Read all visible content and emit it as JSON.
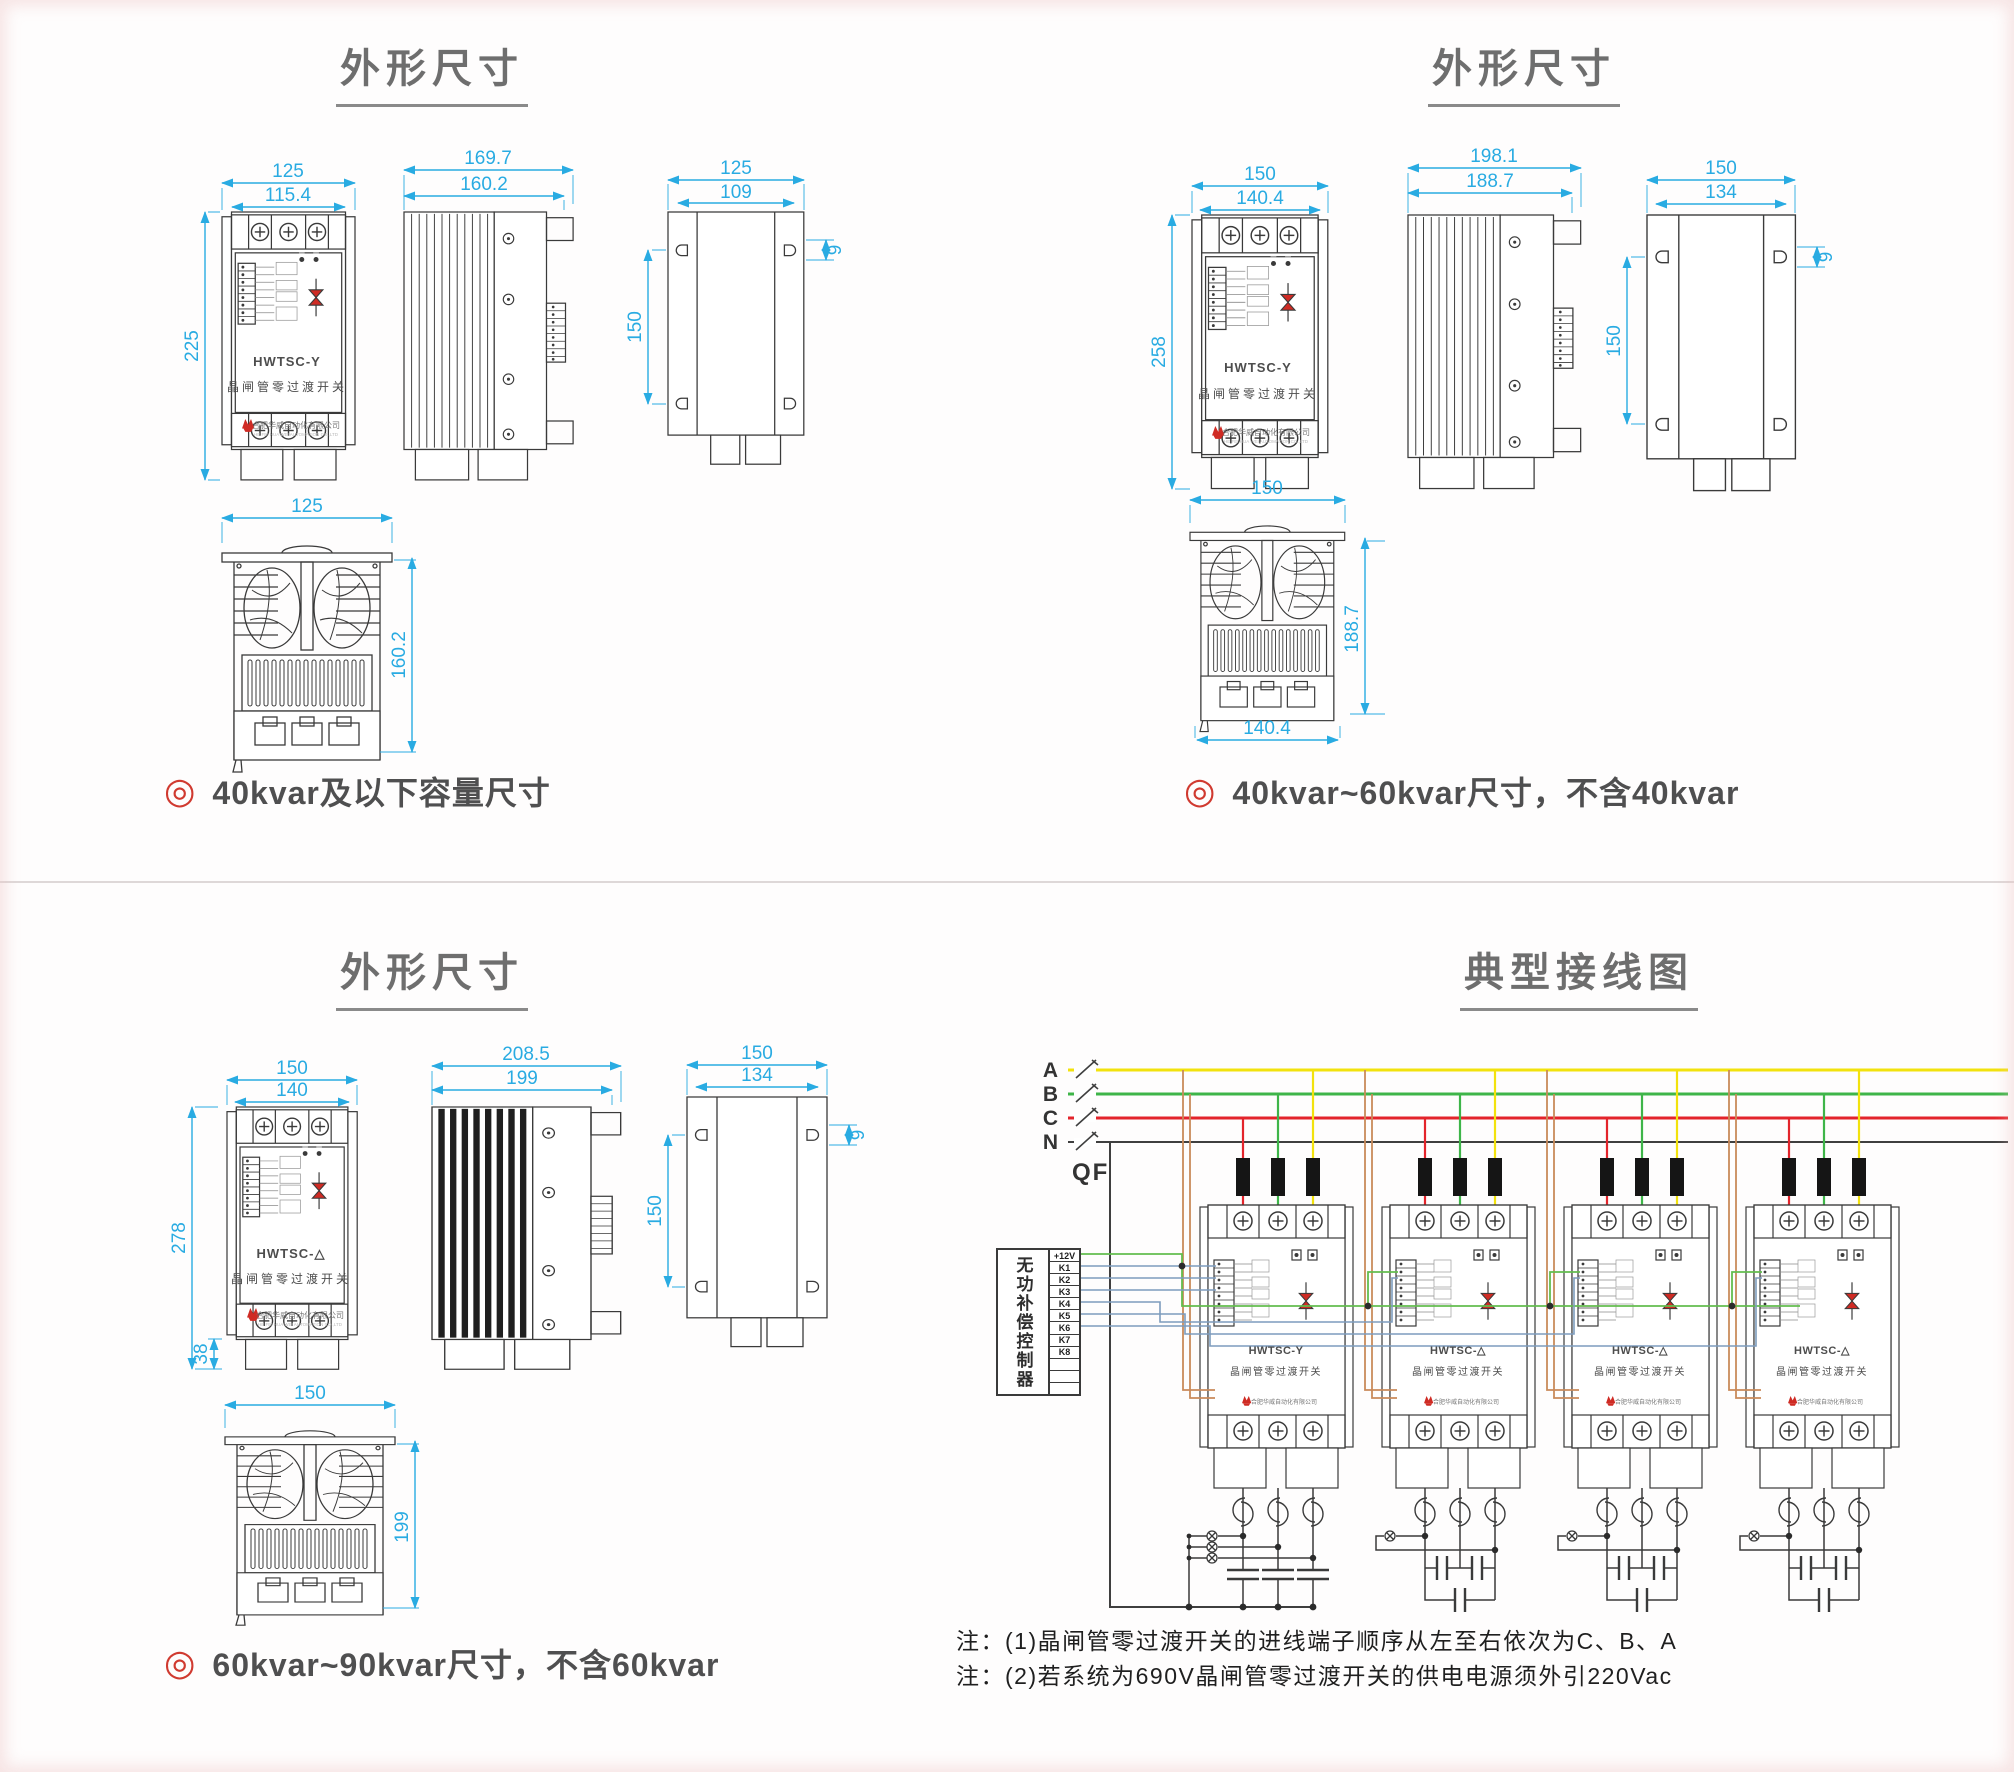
{
  "colors": {
    "dimension": "#29abe2",
    "line_art": "#3a3a3a",
    "accent_red": "#cf2b24",
    "caption_text": "#4f4f50",
    "phase_a_yellow": "#f2e20d",
    "phase_b_green": "#3eb549",
    "phase_c_red": "#e3242b",
    "neutral_black": "#3f3f3f",
    "control_wire_blue": "#7d9cbd",
    "power_wire_green": "#63bd4e",
    "sample_wire_tan": "#c98a5a"
  },
  "quadrants": {
    "tl": {
      "title": "外形尺寸",
      "caption_bullet": "◎",
      "caption": "40kvar及以下容量尺寸",
      "front": {
        "model": "HWTSC-Y",
        "subtitle": "晶闸管零过渡开关",
        "company": "合肥华威自动化有限公司",
        "company_en": "HE FEI HUA WEI AUTOMATION CO.,LTD",
        "dim_outer_width": "125",
        "dim_inner_width": "115.4",
        "dim_height": "225"
      },
      "side": {
        "dim_outer_depth": "169.7",
        "dim_inner_depth": "160.2"
      },
      "back": {
        "dim_outer_width": "125",
        "dim_inner_width": "109",
        "dim_hole_span": "150",
        "dim_hole_offset": "9"
      },
      "top": {
        "dim_width": "125",
        "dim_depth": "160.2"
      }
    },
    "tr": {
      "title": "外形尺寸",
      "caption_bullet": "◎",
      "caption": "40kvar~60kvar尺寸，不含40kvar",
      "front": {
        "model": "HWTSC-Y",
        "subtitle": "晶闸管零过渡开关",
        "company": "合肥华威自动化有限公司",
        "company_en": "HE FEI HUA WEI AUTOMATION CO.,LTD",
        "dim_outer_width": "150",
        "dim_inner_width": "140.4",
        "dim_height": "258"
      },
      "side": {
        "dim_outer_depth": "198.1",
        "dim_inner_depth": "188.7"
      },
      "back": {
        "dim_outer_width": "150",
        "dim_inner_width": "134",
        "dim_hole_span": "150",
        "dim_hole_offset": "9"
      },
      "top": {
        "dim_width": "150",
        "dim_height": "188.7",
        "dim_bottom_width": "140.4"
      }
    },
    "bl": {
      "title": "外形尺寸",
      "caption_bullet": "◎",
      "caption": "60kvar~90kvar尺寸，不含60kvar",
      "front": {
        "model": "HWTSC-△",
        "subtitle": "晶闸管零过渡开关",
        "company": "合肥华威自动化有限公司",
        "company_en": "HE FEI HUA WEI AUTOMATION CO.,LTD",
        "dim_outer_width": "150",
        "dim_inner_width": "140",
        "dim_height": "278",
        "dim_foot_height": "38"
      },
      "side": {
        "dim_outer_depth": "208.5",
        "dim_inner_depth": "199"
      },
      "back": {
        "dim_outer_width": "150",
        "dim_inner_width": "134",
        "dim_hole_span": "150",
        "dim_hole_offset": "9"
      },
      "top": {
        "dim_width": "150",
        "dim_height": "199"
      }
    },
    "br": {
      "title": "典型接线图",
      "phases": [
        "A",
        "B",
        "C",
        "N"
      ],
      "breaker": "QF",
      "controller": {
        "label": "无功补偿控制器",
        "terminals": [
          "+12V",
          "K1",
          "K2",
          "K3",
          "K4",
          "K5",
          "K6",
          "K7",
          "K8"
        ]
      },
      "devices": [
        {
          "model": "HWTSC-Y",
          "subtitle": "晶闸管零过渡开关",
          "company": "合肥华威自动化有限公司"
        },
        {
          "model": "HWTSC-△",
          "subtitle": "晶闸管零过渡开关",
          "company": "合肥华威自动化有限公司"
        },
        {
          "model": "HWTSC-△",
          "subtitle": "晶闸管零过渡开关",
          "company": "合肥华威自动化有限公司"
        },
        {
          "model": "HWTSC-△",
          "subtitle": "晶闸管零过渡开关",
          "company": "合肥华威自动化有限公司"
        }
      ],
      "notes": [
        "注：(1)晶闸管零过渡开关的进线端子顺序从左至右依次为C、B、A",
        "注：(2)若系统为690V晶闸管零过渡开关的供电电源须外引220Vac"
      ]
    }
  }
}
